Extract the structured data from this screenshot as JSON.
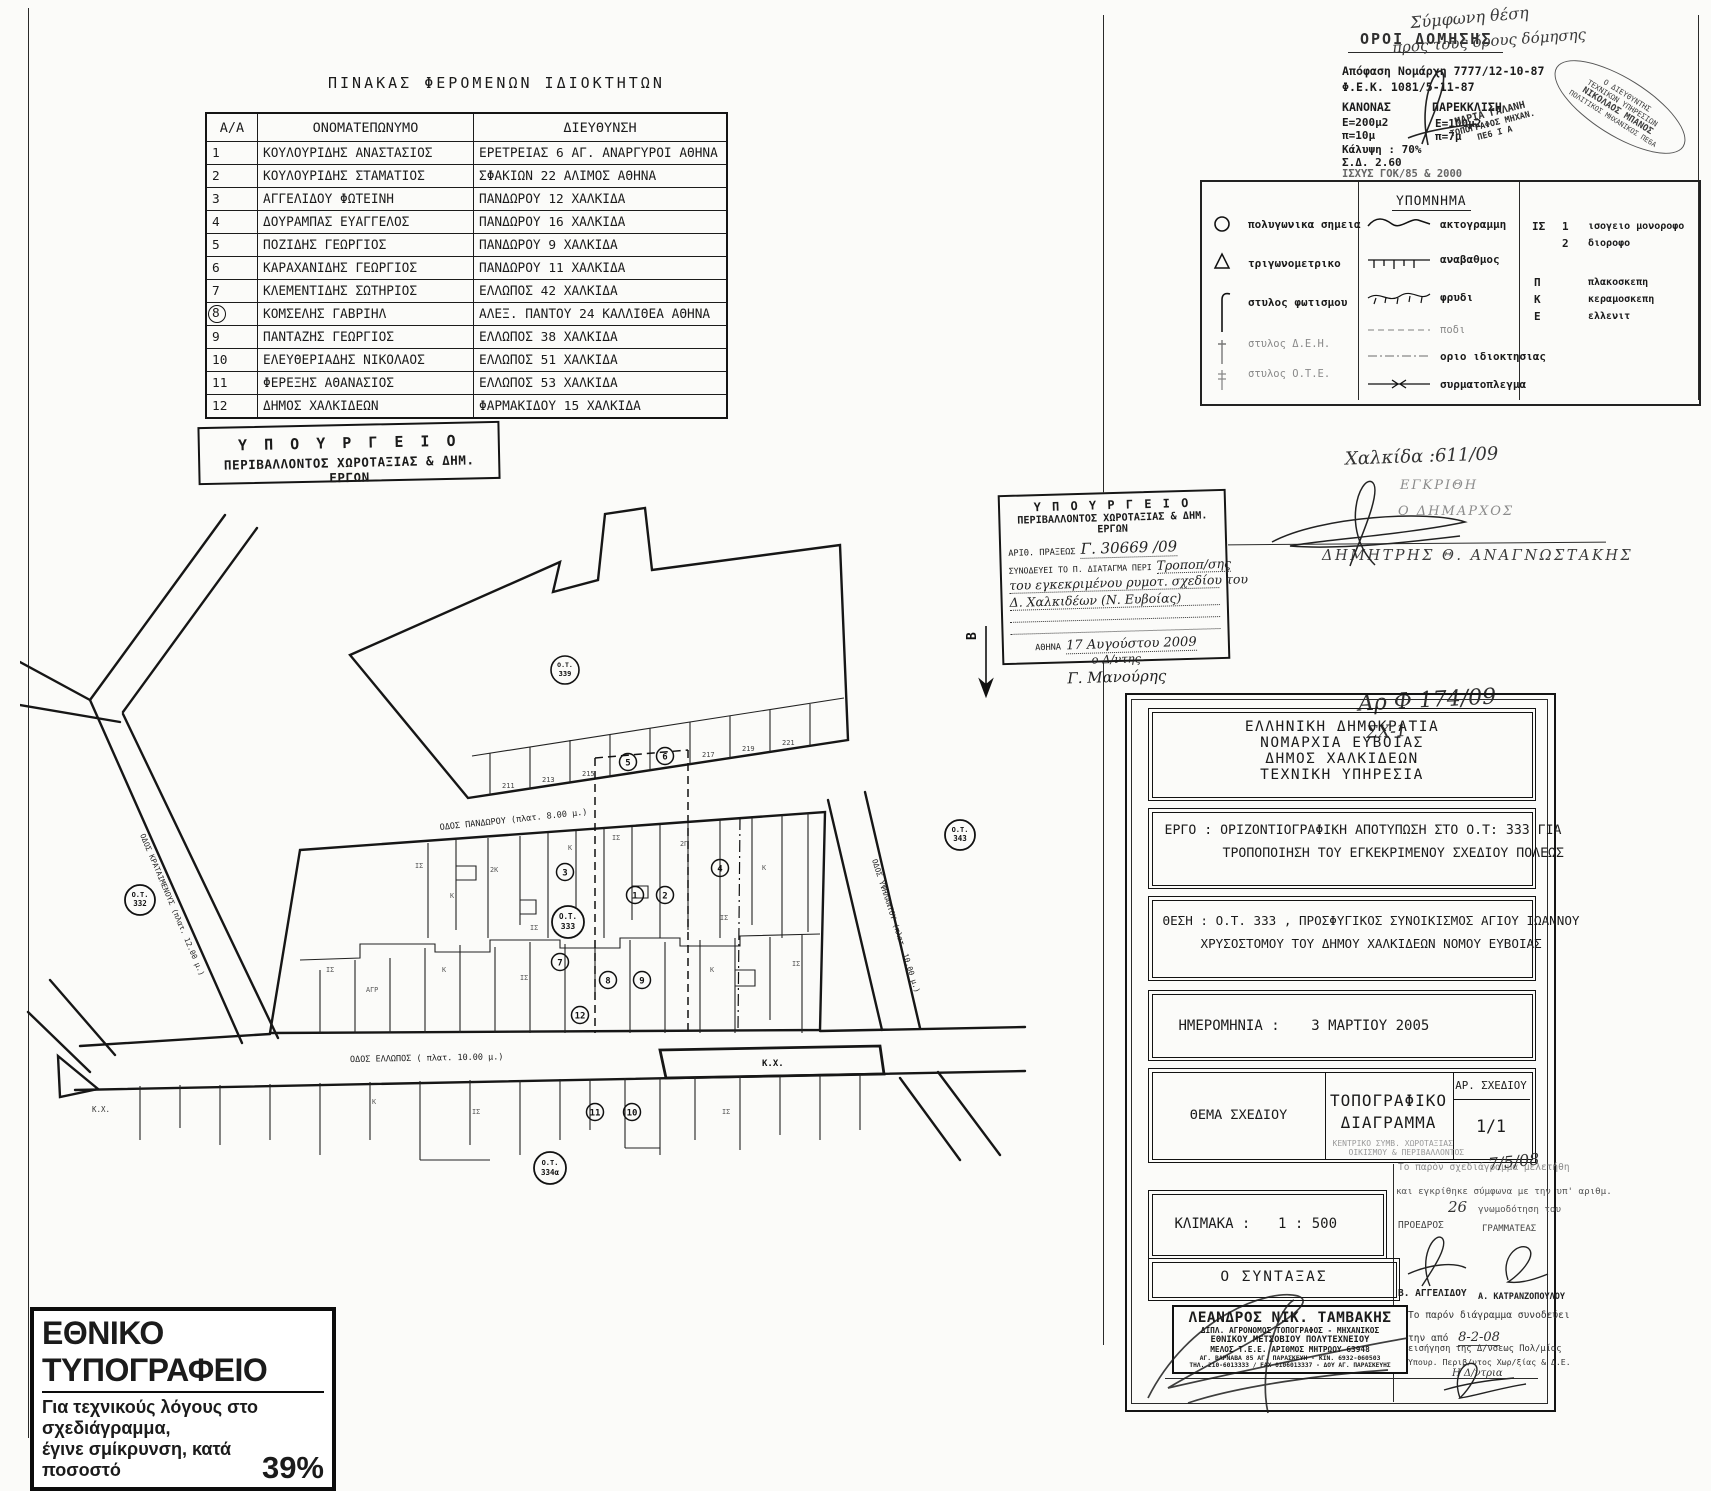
{
  "owners": {
    "title": "ΠΙΝΑΚΑΣ ΦΕΡΟΜΕΝΩΝ ΙΔΙΟΚΤΗΤΩΝ",
    "headers": [
      "Α/Α",
      "ΟΝΟΜΑΤΕΠΩΝΥΜΟ",
      "ΔΙΕΥΘΥΝΣΗ"
    ],
    "rows": [
      {
        "no": "1",
        "name": "ΚΟΥΛΟΥΡΙΔΗΣ ΑΝΑΣΤΑΣΙΟΣ",
        "addr": "ΕΡΕΤΡΕΙΑΣ 6 ΑΓ. ΑΝΑΡΓΥΡΟΙ ΑΘΗΝΑ"
      },
      {
        "no": "2",
        "name": "ΚΟΥΛΟΥΡΙΔΗΣ ΣΤΑΜΑΤΙΟΣ",
        "addr": "ΣΦΑΚΙΩΝ 22 ΑΛΙΜΟΣ ΑΘΗΝΑ"
      },
      {
        "no": "3",
        "name": "ΑΓΓΕΛΙΔΟΥ ΦΩΤΕΙΝΗ",
        "addr": "ΠΑΝΔΩΡΟΥ 12 ΧΑΛΚΙΔΑ"
      },
      {
        "no": "4",
        "name": "ΔΟΥΡΑΜΠΑΣ ΕΥΑΓΓΕΛΟΣ",
        "addr": "ΠΑΝΔΩΡΟΥ 16 ΧΑΛΚΙΔΑ"
      },
      {
        "no": "5",
        "name": "ΠΟΖΙΔΗΣ ΓΕΩΡΓΙΟΣ",
        "addr": "ΠΑΝΔΩΡΟΥ 9 ΧΑΛΚΙΔΑ"
      },
      {
        "no": "6",
        "name": "ΚΑΡΑΧΑΝΙΔΗΣ ΓΕΩΡΓΙΟΣ",
        "addr": "ΠΑΝΔΩΡΟΥ 11 ΧΑΛΚΙΔΑ"
      },
      {
        "no": "7",
        "name": "ΚΛΕΜΕΝΤΙΔΗΣ ΣΩΤΗΡΙΟΣ",
        "addr": "ΕΛΛΩΠΟΣ 42 ΧΑΛΚΙΔΑ"
      },
      {
        "no": "8",
        "name": "ΚΟΜΣΕΛΗΣ ΓΑΒΡΙΗΛ",
        "addr": "ΑΛΕΞ. ΠΑΝΤΟΥ 24 ΚΑΛΛΙΘΕΑ ΑΘΗΝΑ"
      },
      {
        "no": "9",
        "name": "ΠΑΝΤΑΖΗΣ ΓΕΩΡΓΙΟΣ",
        "addr": "ΕΛΛΩΠΟΣ 38 ΧΑΛΚΙΔΑ"
      },
      {
        "no": "10",
        "name": "ΕΛΕΥΘΕΡΙΑΔΗΣ ΝΙΚΟΛΑΟΣ",
        "addr": "ΕΛΛΩΠΟΣ 51 ΧΑΛΚΙΔΑ"
      },
      {
        "no": "11",
        "name": "ΦΕΡΕΞΗΣ ΑΘΑΝΑΣΙΟΣ",
        "addr": "ΕΛΛΩΠΟΣ 53 ΧΑΛΚΙΔΑ"
      },
      {
        "no": "12",
        "name": "ΔΗΜΟΣ ΧΑΛΚΙΔΕΩΝ",
        "addr": "ΦΑΡΜΑΚΙΔΟΥ 15 ΧΑΛΚΙΔΑ"
      }
    ]
  },
  "ministry_left": {
    "l1": "Υ Π Ο Υ Ρ Γ Ε Ι Ο",
    "l2": "ΠΕΡΙΒΑΛΛΟΝΤΟΣ ΧΩΡΟΤΑΞΙΑΣ & ΔΗΜ. ΕΡΓΩΝ"
  },
  "oroi": {
    "title": "ΟΡΟΙ ΔΟΜΗΣΗΣ",
    "l1": "Απόφαση Νομάρχη 7777/12-10-87",
    "l2": "Φ.Ε.Κ. 1081/5-11-87",
    "c1h": "ΚΑΝΟΝΑΣ",
    "c2h": "ΠΑΡΕΚΚΛΙΣΗ",
    "c1a": "Ε=200μ2",
    "c2a": "Ε=100μ2",
    "c1b": "π=10μ",
    "c2b": "π=7μ",
    "l3": "Κάλυψη : 70%",
    "l4": "Σ.Δ. 2.60",
    "l5": "ΙΣΧΥΣ ΓΟΚ/85 & 2000",
    "hand1": "Σύμφωνη θέση",
    "hand2": "προς τους όρους δόμησης",
    "stamp1": [
      "ΜΑΡΙΑ ΓΑΛΑΝΗ",
      "ΤΟΠΟΓΡΑΦΟΣ ΜΗΧΑΝ.",
      "ΠΕ6 Ι Α"
    ],
    "stamp2": [
      "Ο ΔΙΕΥΘΥΝΤΗΣ",
      "ΤΕΧΝΙΚΩΝ ΥΠΗΡΕΣΙΩΝ",
      "ΝΙΚΟΛΑΟΣ ΜΠΑΝΟΣ",
      "ΠΟΛΙΤΙΚΟΣ ΜΗΧΑΝΙΚΟΣ ΠΕ6Α"
    ]
  },
  "legend": {
    "title": "ΥΠΟΜΝΗΜΑ",
    "col1": [
      {
        "label": "πολυγωνικα σημεια"
      },
      {
        "label": "τριγωνομετρικο"
      },
      {
        "label": "στυλος φωτισμου"
      },
      {
        "label": "στυλος Δ.Ε.Η."
      },
      {
        "label": "στυλος Ο.Τ.Ε."
      }
    ],
    "col2": [
      {
        "label": "ακτογραμμη"
      },
      {
        "label": "αναβαθμος"
      },
      {
        "label": "φρυδι"
      },
      {
        "label": "ποδι"
      },
      {
        "label": "οριο ιδιοκτησιας"
      },
      {
        "label": "συρματοπλεγμα"
      }
    ],
    "col3": [
      {
        "k": "ΙΣ",
        "n": "1",
        "label": "ισογειο μονοροφο"
      },
      {
        "k": "",
        "n": "2",
        "label": "διοροφο"
      },
      {
        "k": "Π",
        "n": "",
        "label": "πλακοσκεπη"
      },
      {
        "k": "Κ",
        "n": "",
        "label": "κεραμοσκεπη"
      },
      {
        "k": "Ε",
        "n": "",
        "label": "ελλενιτ"
      }
    ]
  },
  "stamp_box": {
    "t1": "Υ Π Ο Υ Ρ Γ Ε Ι Ο",
    "t2": "ΠΕΡΙΒΑΛΛΟΝΤΟΣ ΧΩΡΟΤΑΞΙΑΣ & ΔΗΜ. ΕΡΓΩΝ",
    "lab1": "ΑΡΙΘ. ΠΡΑΞΕΩΣ",
    "val1": "Γ. 30669 /09",
    "lab2": "ΣΥΝΟΔΕΥΕΙ ΤΟ Π. ΔΙΑΤΑΓΜΑ ΠΕΡΙ",
    "val2": "Τροποπ/σης",
    "val3": "του εγκεκριμένου ρυμοτ. σχεδίου του",
    "val4": "Δ. Χαλκιδέων (Ν. Ευβοίας)",
    "lab3": "ΑΘΗΝΑ",
    "val5": "17 Αυγούστου 2009",
    "val6": "ο Δ/ντης",
    "val7": "Γ. Μανούρης",
    "north": "Β"
  },
  "notes": {
    "a1": "Χαλκίδα :611/09",
    "a2": "ΕΓΚΡΙΘΗ",
    "a3": "Ο ΔΗΜΑΡΧΟΣ",
    "a4": "ΔΗΜΗΤΡΗΣ Θ. ΑΝΑΓΝΩΣΤΑΚΗΣ",
    "a5": "Αρ Φ 174/09",
    "a6": "ΣΧ-1"
  },
  "title_block": {
    "agency": [
      "ΕΛΛΗΝΙΚΗ ΔΗΜΟΚΡΑΤΙΑ",
      "ΝΟΜΑΡΧΙΑ ΕΥΒΟΙΑΣ",
      "ΔΗΜΟΣ ΧΑΛΚΙΔΕΩΝ",
      "ΤΕΧΝΙΚΗ ΥΠΗΡΕΣΙΑ"
    ],
    "ergo1": "ΕΡΓΟ : ΟΡΙΖΟΝΤΙΟΓΡΑΦΙΚΗ ΑΠΟΤΥΠΩΣΗ ΣΤΟ Ο.Τ: 333 ΓΙΑ",
    "ergo2": "ΤΡΟΠΟΠΟΙΗΣΗ ΤΟΥ ΕΓΚΕΚΡΙΜΕΝΟΥ ΣΧΕΔΙΟΥ ΠΟΛΕΩΣ",
    "thesi1": "ΘΕΣΗ : Ο.Τ. 333 , ΠΡΟΣΦΥΓΙΚΟΣ ΣΥΝΟΙΚΙΣΜΟΣ ΑΓΙΟΥ ΙΩΑΝΝΟΥ",
    "thesi2": "ΧΡΥΣΟΣΤΟΜΟΥ ΤΟΥ ΔΗΜΟΥ ΧΑΛΚΙΔΕΩΝ ΝΟΜΟΥ ΕΥΒΟΙΑΣ",
    "date_label": "ΗΜΕΡΟΜΗΝΙΑ  :",
    "date_value": "3 ΜΑΡΤΙΟΥ 2005",
    "thema_label": "ΘΕΜΑ ΣΧΕΔΙΟΥ",
    "thema1": "ΤΟΠΟΓΡΑΦΙΚΟ",
    "thema2": "ΔΙΑΓΡΑΜΜΑ",
    "ar_label": "ΑΡ. ΣΧΕΔΙΟΥ",
    "ar_value": "1/1",
    "st1": "ΚΕΝΤΡΙΚΟ ΣΥΜΒ. ΧΩΡΟΤΑΞΙΑΣ",
    "st2": "ΟΙΚΙΣΜΟΥ & ΠΕΡΙΒΑΛΛΟΝΤΟΣ",
    "klimaka_label": "ΚΛΙΜΑΚΑ   :",
    "klimaka_value": "1 : 500",
    "ap1": "Το παρόν σχεδιάγραμμα μελετήθη",
    "ap_date": "7/5/08",
    "ap2": "και εγκρίθηκε σύμφωνα με την υπ' αριθμ.",
    "ap_num": "26",
    "ap3": "γνωμοδότηση του",
    "ap4": "ΠΡΟΕΔΡΟΣ",
    "ap5": "ΓΡΑΜΜΑΤΕΑΣ",
    "ap6": "Β. ΑΓΓΕΛΙΔΟΥ",
    "ap7": "Α. ΚΑΤΡΑΝΖΟΠΟΥΛΟΥ",
    "syntaxas_label": "Ο  ΣΥΝΤΑΞΑΣ",
    "stamp": [
      "ΛΕΑΝΔΡΟΣ ΝΙΚ. ΤΑΜΒΑΚΗΣ",
      "ΔΙΠΛ. ΑΓΡΟΝΟΜΟΣ ΤΟΠΟΓΡΑΦΟΣ - ΜΗΧΑΝΙΚΟΣ",
      "ΕΘΝΙΚΟΥ ΜΕΤΣΟΒΙΟΥ ΠΟΛΥΤΕΧΝΕΙΟΥ",
      "ΜΕΛΟΣ Τ.Ε.Ε. ΑΡΙΘΜΟΣ ΜΗΤΡΩΟΥ 63948",
      "ΑΓ. ΒΑΡΝΑΒΑ 85 ΑΓ. ΠΑΡΑΣΚΕΥΗ - ΚΙΝ. 6932-060503",
      "ΤΗΛ. 210-6013333 / FAX 0106013337 - ΔΟΥ ΑΓ. ΠΑΡΑΣΚΕΥΗΣ"
    ],
    "n1": "Το παρόν διάγραμμα συνοδεύει",
    "n2": "την από",
    "n2v": "8-2-08",
    "n3": "εισήγηση της Δ/νσεως Πολ/μίας",
    "n4": "Υπουρ. Περιβ/ντος Χωρ/ξίας & Δ.Ε.",
    "n5": "Η Δ/ντρια"
  },
  "map": {
    "street_top": "ΟΔΟΣ ΠΑΝΔΩΡΟΥ (πλατ. 8.00 μ.)",
    "street_bottom": "ΟΔΟΣ ΕΛΛΩΠΟΣ ( πλατ. 10.00 μ.)",
    "street_left": "ΟΔΟΣ ΚΡΑΤΑΙΜΕΝΟΥΣ (πλατ. 12.00 μ.)",
    "street_right": "ΟΔΟΣ ΥΨΗΛΑΝΤΟΥ (πλατ. 10.00 μ.)",
    "kx": "Κ.Χ.",
    "kx2": "Κ.Χ.",
    "blocks": [
      {
        "p": "Ο.Τ.",
        "n": "332"
      },
      {
        "p": "Ο.Τ.",
        "n": "333"
      },
      {
        "p": "Ο.Τ.",
        "n": "339"
      },
      {
        "p": "Ο.Τ.",
        "n": "343"
      },
      {
        "p": "Ο.Τ.",
        "n": "334α"
      }
    ],
    "strip": [
      "211",
      "213",
      "215",
      "217",
      "219",
      "221"
    ],
    "circled": [
      "1",
      "2",
      "3",
      "4",
      "5",
      "6",
      "7",
      "8",
      "9",
      "10",
      "11",
      "12"
    ],
    "tiny": [
      "ΙΣ",
      "Κ",
      "2Κ",
      "ΙΣ",
      "Κ",
      "ΙΣ",
      "2Π",
      "ΙΣ",
      "Κ",
      "ΙΣ",
      "ΑΓΡ",
      "Κ",
      "ΙΣ",
      "Κ",
      "ΙΣ",
      "Κ",
      "ΙΣ",
      "ΙΣ"
    ]
  },
  "printing": {
    "t": "ΕΘΝΙΚΟ ΤΥΠΟΓΡΑΦΕΙΟ",
    "l1": "Για τεχνικούς λόγους στο σχεδιάγραμμα,",
    "l2": "έγινε σμίκρυνση, κατά ποσοστό",
    "pct": "39%"
  }
}
